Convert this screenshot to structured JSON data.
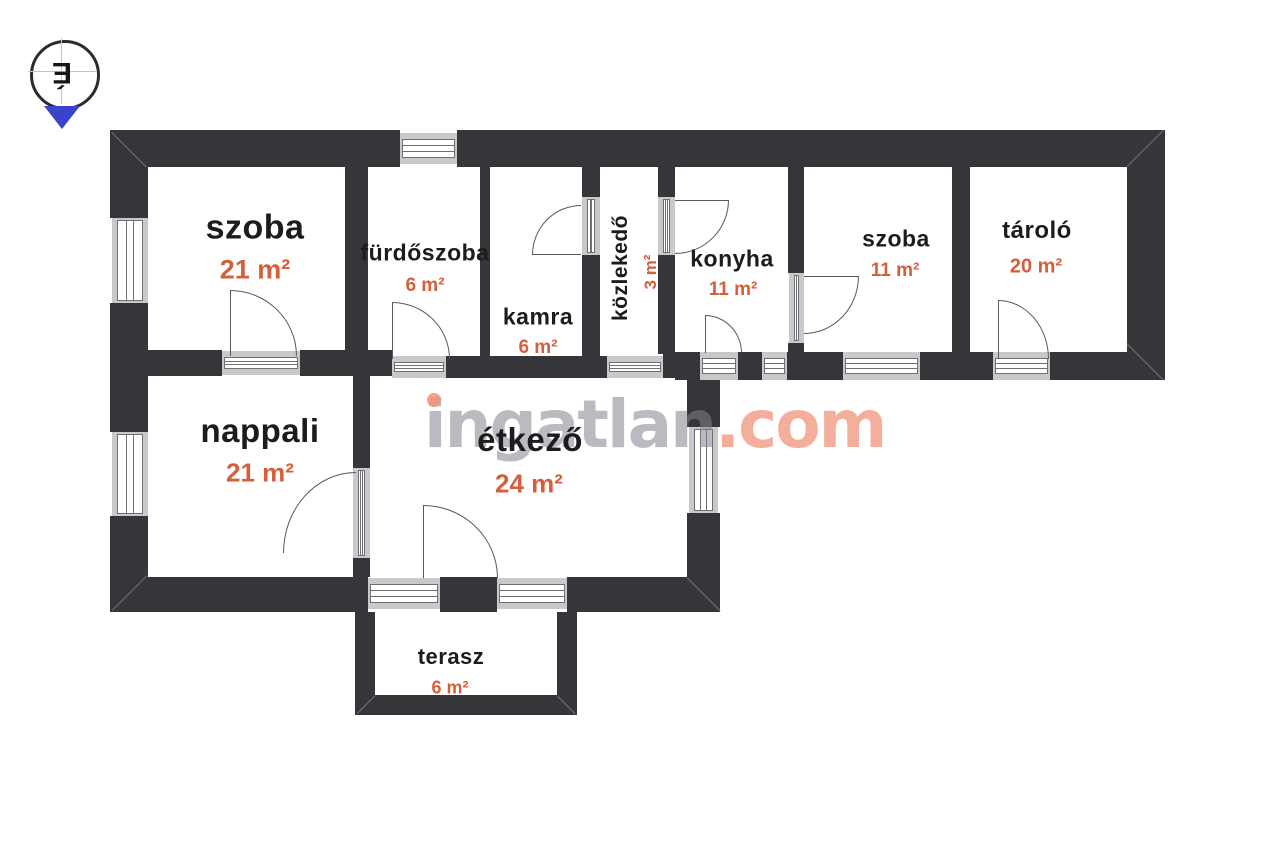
{
  "compass": {
    "north_letter": "É"
  },
  "watermark": {
    "brand": "ingatlan",
    "tld": ".com"
  },
  "rooms": {
    "szoba1": {
      "label": "szoba",
      "area": "21 m²"
    },
    "furdoszoba": {
      "label": "fürdőszoba",
      "area": "6 m²"
    },
    "kamra": {
      "label": "kamra",
      "area": "6 m²"
    },
    "kozlekedo": {
      "label": "közlekedő",
      "area": "3 m²"
    },
    "konyha": {
      "label": "konyha",
      "area": "11 m²"
    },
    "szoba2": {
      "label": "szoba",
      "area": "11 m²"
    },
    "tarolo": {
      "label": "tároló",
      "area": "20 m²"
    },
    "nappali": {
      "label": "nappali",
      "area": "21 m²"
    },
    "etkezo": {
      "label": "étkező",
      "area": "24 m²"
    },
    "terasz": {
      "label": "terasz",
      "area": "6 m²"
    }
  },
  "colors": {
    "wall": "#35353a",
    "window_band": "#c9c9c9",
    "room_label": "#1c1c1e",
    "area_label": "#d55f3a",
    "watermark_gray": "#82828e",
    "watermark_accent": "#eb7d5f",
    "compass_arrow": "#3a43cb"
  }
}
